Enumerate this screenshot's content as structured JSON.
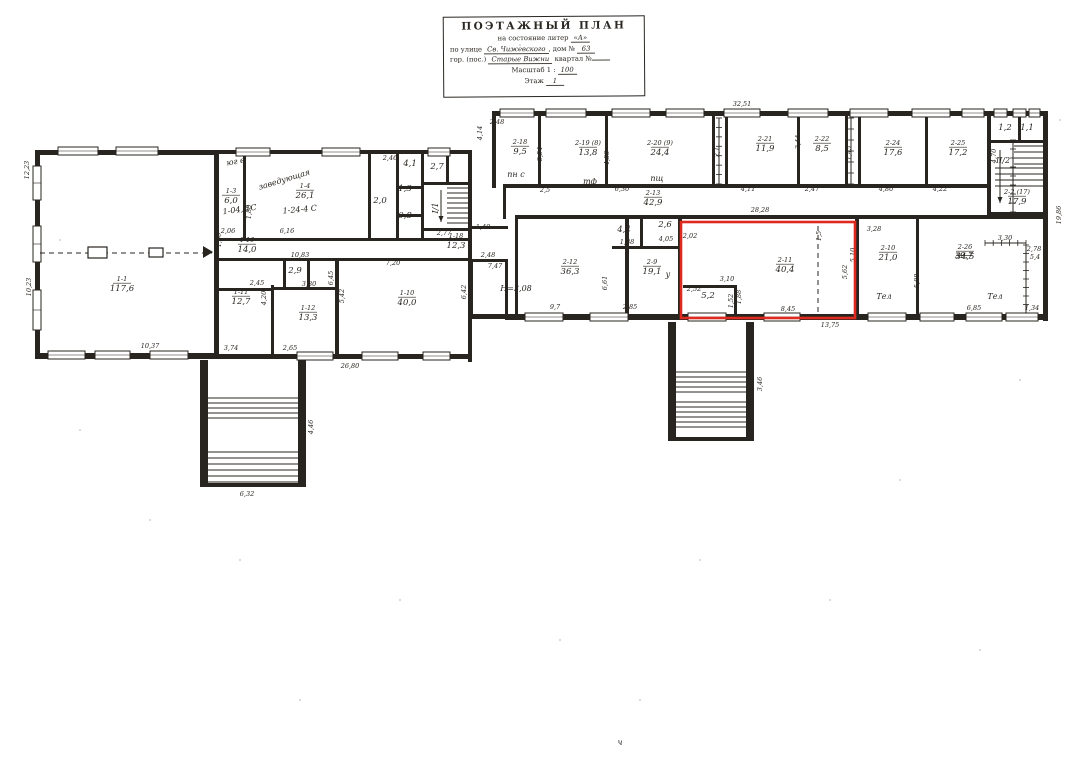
{
  "title_block": {
    "title": "ПОЭТАЖНЫЙ ПЛАН",
    "state_label": "на состояние литер",
    "state_value": "«А»",
    "street_label": "по улице",
    "street_value": "Св. Чижевского",
    "house_label": ", дом №",
    "house_value": "63",
    "city_label": "гор. (пос.)",
    "city_value": "Старые Вижни",
    "block_label": "квартал №",
    "block_value": "",
    "scale_label": "Масштаб 1 :",
    "scale_value": "100",
    "floor_label": "Этаж",
    "floor_value": "1"
  },
  "plan": {
    "ink": "#28241f",
    "red": "#df2b1f",
    "red_box": {
      "x": 681,
      "y": 222,
      "w": 174,
      "h": 96
    },
    "walls": [
      [
        35,
        150,
        184,
        5
      ],
      [
        35,
        150,
        5,
        208
      ],
      [
        35,
        353,
        184,
        6
      ],
      [
        214,
        150,
        5,
        209
      ],
      [
        219,
        150,
        253,
        4
      ],
      [
        468,
        150,
        4,
        212
      ],
      [
        219,
        354,
        253,
        5
      ],
      [
        243,
        154,
        3,
        86
      ],
      [
        368,
        154,
        3,
        86
      ],
      [
        219,
        238,
        253,
        3
      ],
      [
        219,
        258,
        253,
        3
      ],
      [
        396,
        154,
        3,
        84
      ],
      [
        421,
        154,
        3,
        84
      ],
      [
        396,
        186,
        28,
        3
      ],
      [
        396,
        214,
        28,
        3
      ],
      [
        421,
        182,
        50,
        3
      ],
      [
        446,
        154,
        3,
        30
      ],
      [
        424,
        228,
        48,
        3
      ],
      [
        219,
        288,
        55,
        3
      ],
      [
        271,
        285,
        3,
        71
      ],
      [
        283,
        258,
        3,
        32
      ],
      [
        307,
        258,
        3,
        32
      ],
      [
        274,
        287,
        64,
        3
      ],
      [
        335,
        258,
        4,
        98
      ],
      [
        492,
        111,
        556,
        5
      ],
      [
        492,
        111,
        4,
        77
      ],
      [
        505,
        184,
        484,
        4
      ],
      [
        538,
        116,
        3,
        70
      ],
      [
        605,
        116,
        3,
        70
      ],
      [
        712,
        116,
        3,
        70
      ],
      [
        725,
        116,
        3,
        70
      ],
      [
        797,
        116,
        3,
        70
      ],
      [
        845,
        116,
        3,
        70
      ],
      [
        858,
        116,
        3,
        70
      ],
      [
        925,
        116,
        3,
        70
      ],
      [
        987,
        111,
        4,
        106
      ],
      [
        515,
        215,
        533,
        4
      ],
      [
        1043,
        111,
        5,
        210
      ],
      [
        505,
        314,
        543,
        6
      ],
      [
        503,
        184,
        3,
        35
      ],
      [
        468,
        226,
        40,
        3
      ],
      [
        468,
        259,
        40,
        3
      ],
      [
        468,
        226,
        3,
        36
      ],
      [
        470,
        262,
        3,
        55
      ],
      [
        470,
        314,
        38,
        5
      ],
      [
        505,
        259,
        3,
        58
      ],
      [
        515,
        219,
        3,
        98
      ],
      [
        625,
        219,
        4,
        96
      ],
      [
        678,
        219,
        4,
        96
      ],
      [
        855,
        219,
        4,
        96
      ],
      [
        916,
        219,
        3,
        96
      ],
      [
        612,
        246,
        69,
        3
      ],
      [
        640,
        219,
        3,
        30
      ],
      [
        683,
        285,
        54,
        3
      ],
      [
        734,
        285,
        3,
        30
      ],
      [
        990,
        140,
        53,
        3
      ],
      [
        1018,
        116,
        3,
        26
      ],
      [
        988,
        212,
        57,
        3
      ],
      [
        200,
        360,
        8,
        126
      ],
      [
        298,
        360,
        8,
        126
      ],
      [
        200,
        483,
        106,
        4
      ],
      [
        668,
        322,
        8,
        118
      ],
      [
        746,
        322,
        8,
        118
      ],
      [
        668,
        437,
        86,
        4
      ]
    ],
    "windows": [
      [
        58,
        147,
        40,
        8
      ],
      [
        116,
        147,
        42,
        8
      ],
      [
        33,
        166,
        8,
        34
      ],
      [
        33,
        226,
        8,
        36
      ],
      [
        33,
        290,
        8,
        40
      ],
      [
        48,
        351,
        37,
        8
      ],
      [
        95,
        351,
        35,
        8
      ],
      [
        150,
        351,
        38,
        8
      ],
      [
        236,
        148,
        34,
        8
      ],
      [
        322,
        148,
        38,
        8
      ],
      [
        428,
        148,
        22,
        8
      ],
      [
        297,
        352,
        36,
        8
      ],
      [
        362,
        352,
        36,
        8
      ],
      [
        423,
        352,
        27,
        8
      ],
      [
        500,
        109,
        34,
        8
      ],
      [
        546,
        109,
        40,
        8
      ],
      [
        612,
        109,
        38,
        8
      ],
      [
        666,
        109,
        38,
        8
      ],
      [
        724,
        109,
        36,
        8
      ],
      [
        788,
        109,
        40,
        8
      ],
      [
        850,
        109,
        38,
        8
      ],
      [
        912,
        109,
        38,
        8
      ],
      [
        962,
        109,
        22,
        8
      ],
      [
        994,
        109,
        13,
        8
      ],
      [
        1013,
        109,
        13,
        8
      ],
      [
        1029,
        109,
        11,
        8
      ],
      [
        525,
        313,
        38,
        8
      ],
      [
        590,
        313,
        38,
        8
      ],
      [
        688,
        313,
        38,
        8
      ],
      [
        764,
        313,
        36,
        8
      ],
      [
        868,
        313,
        38,
        8
      ],
      [
        920,
        313,
        34,
        8
      ],
      [
        966,
        313,
        36,
        8
      ],
      [
        1006,
        313,
        32,
        8
      ]
    ],
    "stairs": [
      {
        "x": 447,
        "y": 188,
        "w": 21,
        "n": 8,
        "gap": 5
      },
      {
        "x": 1014,
        "y": 146,
        "w": 29,
        "n": 4,
        "gap": 6
      },
      {
        "x": 995,
        "y": 168,
        "w": 48,
        "n": 4,
        "gap": 6
      },
      {
        "x": 208,
        "y": 398,
        "w": 90,
        "n": 5,
        "gap": 5
      },
      {
        "x": 208,
        "y": 452,
        "w": 90,
        "n": 6,
        "gap": 6
      },
      {
        "x": 676,
        "y": 372,
        "w": 70,
        "n": 5,
        "gap": 5
      },
      {
        "x": 676,
        "y": 402,
        "w": 70,
        "n": 6,
        "gap": 5
      }
    ],
    "ticklines": [
      {
        "x1": 1026,
        "y1": 245,
        "x2": 1026,
        "y2": 313,
        "n": 8
      },
      {
        "x1": 985,
        "y1": 243,
        "x2": 1026,
        "y2": 243,
        "n": 5
      },
      {
        "x1": 719,
        "y1": 118,
        "x2": 719,
        "y2": 184,
        "n": 7
      },
      {
        "x1": 851,
        "y1": 118,
        "x2": 851,
        "y2": 184,
        "n": 6
      },
      {
        "x1": 1013,
        "y1": 140,
        "x2": 1013,
        "y2": 212,
        "n": 8
      }
    ],
    "dashed": [
      [
        40,
        253,
        212,
        253
      ],
      [
        818,
        226,
        818,
        313
      ]
    ],
    "piers": [
      [
        88,
        247,
        19,
        11
      ],
      [
        149,
        248,
        14,
        9
      ]
    ],
    "triangles": [
      "203,246 213,252 203,258"
    ],
    "arrows": [
      {
        "x": 441,
        "y1": 190,
        "y2": 222
      },
      {
        "x": 1000,
        "y1": 150,
        "y2": 203
      }
    ],
    "rooms": [
      {
        "c": "1-1",
        "a": "117,6",
        "x": 122,
        "y": 281
      },
      {
        "c": "1-3",
        "a": "6,0",
        "x": 231,
        "y": 193
      },
      {
        "c": "1-4",
        "a": "26,1",
        "x": 305,
        "y": 188
      },
      {
        "c": "1-16",
        "a": "14,0",
        "x": 247,
        "y": 242
      },
      {
        "c": "1-18",
        "a": "12,3",
        "x": 456,
        "y": 238
      },
      {
        "c": "1-11",
        "a": "12,7",
        "x": 241,
        "y": 294
      },
      {
        "c": "1-12",
        "a": "13,3",
        "x": 308,
        "y": 310
      },
      {
        "c": "1-10",
        "a": "40,0",
        "x": 407,
        "y": 295
      },
      {
        "c": "2-18",
        "a": "9,5",
        "x": 520,
        "y": 144
      },
      {
        "c": "2-19 (8)",
        "a": "13,8",
        "x": 588,
        "y": 145
      },
      {
        "c": "2-20 (9)",
        "a": "24,4",
        "x": 660,
        "y": 145
      },
      {
        "c": "2-21",
        "a": "11,9",
        "x": 765,
        "y": 141
      },
      {
        "c": "2-22",
        "a": "8,5",
        "x": 822,
        "y": 141
      },
      {
        "c": "2-24",
        "a": "17,6",
        "x": 893,
        "y": 145
      },
      {
        "c": "2-25",
        "a": "17,2",
        "x": 958,
        "y": 145
      },
      {
        "c": "2-13",
        "a": "42,9",
        "x": 653,
        "y": 195
      },
      {
        "c": "2-12",
        "a": "36,3",
        "x": 570,
        "y": 264
      },
      {
        "c": "2-9",
        "a": "19,1",
        "x": 652,
        "y": 264
      },
      {
        "c": "2-11",
        "a": "40,4",
        "x": 785,
        "y": 262
      },
      {
        "c": "2-10",
        "a": "21,0",
        "x": 888,
        "y": 250
      },
      {
        "c": "2-26",
        "a": "34,5",
        "x": 965,
        "y": 249
      },
      {
        "c": "2-2 (17)",
        "a": "17,9",
        "x": 1017,
        "y": 194
      },
      {
        "c": "",
        "a": "5,2",
        "x": 708,
        "y": 292
      },
      {
        "c": "",
        "a": "2,9",
        "x": 295,
        "y": 267
      },
      {
        "c": "",
        "a": "2,0",
        "x": 380,
        "y": 197
      },
      {
        "c": "",
        "a": "2,7",
        "x": 437,
        "y": 163
      },
      {
        "c": "",
        "a": "4,4",
        "x": 624,
        "y": 226
      },
      {
        "c": "",
        "a": "2,6",
        "x": 665,
        "y": 221
      },
      {
        "c": "",
        "a": "1,2",
        "x": 1005,
        "y": 124
      },
      {
        "c": "",
        "a": "1,1",
        "x": 1027,
        "y": 124
      },
      {
        "c": "",
        "a": "1,3",
        "x": 405,
        "y": 185
      },
      {
        "c": "",
        "a": "0,8",
        "x": 405,
        "y": 212
      },
      {
        "c": "",
        "a": "4,1",
        "x": 410,
        "y": 160
      }
    ],
    "dims": [
      {
        "t": "10,37",
        "x": 150,
        "y": 348
      },
      {
        "t": "10,23",
        "x": 31,
        "y": 287,
        "r": -90
      },
      {
        "t": "12,23",
        "x": 29,
        "y": 170,
        "r": -90
      },
      {
        "t": "2,06",
        "x": 228,
        "y": 233
      },
      {
        "t": "6,16",
        "x": 287,
        "y": 233
      },
      {
        "t": "1,50",
        "x": 221,
        "y": 240,
        "r": -90
      },
      {
        "t": "1,88",
        "x": 251,
        "y": 212,
        "r": -90
      },
      {
        "t": "2,46",
        "x": 390,
        "y": 160
      },
      {
        "t": "10,83",
        "x": 300,
        "y": 257
      },
      {
        "t": "2,45",
        "x": 257,
        "y": 285
      },
      {
        "t": "4,20",
        "x": 266,
        "y": 298,
        "r": -90
      },
      {
        "t": "3,80",
        "x": 309,
        "y": 286
      },
      {
        "t": "6,45",
        "x": 333,
        "y": 278,
        "r": -90
      },
      {
        "t": "5,42",
        "x": 344,
        "y": 296,
        "r": -90
      },
      {
        "t": "7,20",
        "x": 393,
        "y": 265
      },
      {
        "t": "2,77",
        "x": 444,
        "y": 235
      },
      {
        "t": "3,74",
        "x": 231,
        "y": 350
      },
      {
        "t": "2,65",
        "x": 290,
        "y": 350
      },
      {
        "t": "26,80",
        "x": 350,
        "y": 368
      },
      {
        "t": "6,32",
        "x": 247,
        "y": 496
      },
      {
        "t": "4,46",
        "x": 313,
        "y": 427,
        "r": -90
      },
      {
        "t": "3,46",
        "x": 762,
        "y": 384,
        "r": -90
      },
      {
        "t": "32,51",
        "x": 742,
        "y": 106
      },
      {
        "t": "2,48",
        "x": 497,
        "y": 124
      },
      {
        "t": "4,14",
        "x": 482,
        "y": 133,
        "r": -90
      },
      {
        "t": "3,54",
        "x": 542,
        "y": 154,
        "r": -90
      },
      {
        "t": "4,88",
        "x": 609,
        "y": 158,
        "r": -90
      },
      {
        "t": "2,1",
        "x": 719,
        "y": 152,
        "r": -90
      },
      {
        "t": "1,45",
        "x": 851,
        "y": 153,
        "r": -90
      },
      {
        "t": "3,44",
        "x": 800,
        "y": 142,
        "r": -90
      },
      {
        "t": "2,5",
        "x": 545,
        "y": 192
      },
      {
        "t": "6,30",
        "x": 622,
        "y": 191
      },
      {
        "t": "4,11",
        "x": 748,
        "y": 191
      },
      {
        "t": "2,47",
        "x": 812,
        "y": 191
      },
      {
        "t": "4,80",
        "x": 886,
        "y": 191
      },
      {
        "t": "4,22",
        "x": 940,
        "y": 191
      },
      {
        "t": "4,70",
        "x": 996,
        "y": 156,
        "r": -90
      },
      {
        "t": "28,28",
        "x": 760,
        "y": 212
      },
      {
        "t": "1,40",
        "x": 483,
        "y": 229
      },
      {
        "t": "2,48",
        "x": 488,
        "y": 257
      },
      {
        "t": "7,47",
        "x": 495,
        "y": 268
      },
      {
        "t": "6,42",
        "x": 466,
        "y": 292,
        "r": -90
      },
      {
        "t": "9,7",
        "x": 555,
        "y": 309
      },
      {
        "t": "6,61",
        "x": 607,
        "y": 283,
        "r": -90
      },
      {
        "t": "2,85",
        "x": 630,
        "y": 309
      },
      {
        "t": "1,88",
        "x": 627,
        "y": 244
      },
      {
        "t": "4,05",
        "x": 666,
        "y": 241
      },
      {
        "t": "2,02",
        "x": 690,
        "y": 238
      },
      {
        "t": "2,52",
        "x": 694,
        "y": 291
      },
      {
        "t": "3,10",
        "x": 727,
        "y": 281
      },
      {
        "t": "1,52",
        "x": 733,
        "y": 301,
        "r": -90
      },
      {
        "t": "1,88",
        "x": 741,
        "y": 297,
        "r": -90
      },
      {
        "t": "8,45",
        "x": 788,
        "y": 311
      },
      {
        "t": "1,5",
        "x": 821,
        "y": 236,
        "r": -90
      },
      {
        "t": "5,62",
        "x": 847,
        "y": 272,
        "r": -90
      },
      {
        "t": "5,10",
        "x": 855,
        "y": 255,
        "r": -90
      },
      {
        "t": "13,75",
        "x": 830,
        "y": 327
      },
      {
        "t": "3,28",
        "x": 874,
        "y": 231
      },
      {
        "t": "5,88",
        "x": 919,
        "y": 281,
        "r": -90
      },
      {
        "t": "3,30",
        "x": 1005,
        "y": 240
      },
      {
        "t": "2,78",
        "x": 1034,
        "y": 251
      },
      {
        "t": "5,4",
        "x": 1035,
        "y": 259
      },
      {
        "t": "6,85",
        "x": 974,
        "y": 310
      },
      {
        "t": "1,34",
        "x": 1032,
        "y": 310
      },
      {
        "t": "2,9",
        "x": 1010,
        "y": 218
      },
      {
        "t": "19,86",
        "x": 1061,
        "y": 215,
        "r": -90
      }
    ],
    "notes": [
      {
        "t": "заведующая",
        "x": 285,
        "y": 182,
        "r": -17
      },
      {
        "t": "юг в",
        "x": 236,
        "y": 164,
        "r": -10
      },
      {
        "t": "1-04, 1С",
        "x": 240,
        "y": 212,
        "r": -8
      },
      {
        "t": "1-24-4 С",
        "x": 300,
        "y": 212,
        "r": -5
      },
      {
        "t": "пн с",
        "x": 516,
        "y": 177
      },
      {
        "t": "тф",
        "x": 590,
        "y": 184
      },
      {
        "t": "пщ",
        "x": 657,
        "y": 181
      },
      {
        "t": "Тел",
        "x": 884,
        "y": 299
      },
      {
        "t": "Тел",
        "x": 995,
        "y": 299
      },
      {
        "t": "у",
        "x": 668,
        "y": 277
      },
      {
        "t": "I/1",
        "x": 438,
        "y": 208,
        "r": -90
      },
      {
        "t": "II/2",
        "x": 1003,
        "y": 163
      },
      {
        "t": "Н=3,08",
        "x": 516,
        "y": 291
      },
      {
        "t": "39,7",
        "x": 964,
        "y": 258,
        "strike": true
      },
      {
        "t": "ч",
        "x": 620,
        "y": 745
      }
    ],
    "specks": [
      [
        150,
        520
      ],
      [
        400,
        600
      ],
      [
        700,
        560
      ],
      [
        900,
        480
      ],
      [
        300,
        700
      ],
      [
        980,
        650
      ],
      [
        80,
        430
      ],
      [
        560,
        640
      ],
      [
        830,
        600
      ],
      [
        1020,
        380
      ],
      [
        240,
        560
      ],
      [
        640,
        700
      ],
      [
        60,
        240
      ],
      [
        1060,
        120
      ],
      [
        520,
        45
      ]
    ]
  }
}
